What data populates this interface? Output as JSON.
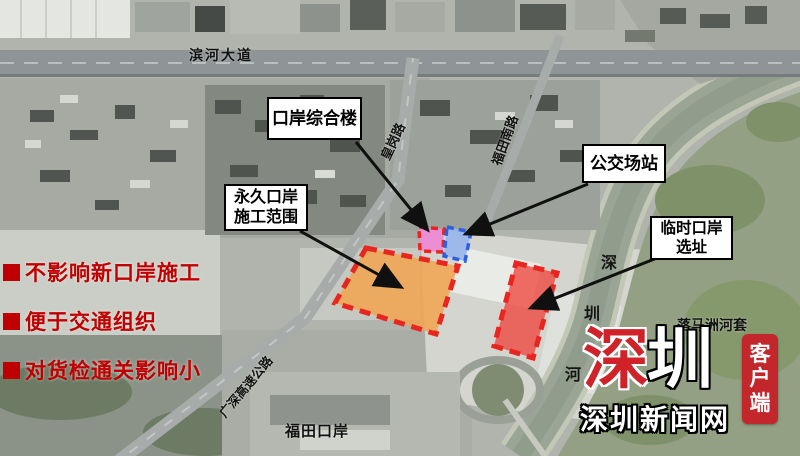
{
  "map_labels": {
    "binhe_avenue": "滨河大道",
    "huanggang_road": "皇岗路",
    "futian_south_road": "福田南路",
    "guangshen_expressway": "广深高速公路",
    "futian_port": "福田口岸",
    "lok_ma_chau_loop": "落马洲河套",
    "shenzhen_river_chars": [
      "深",
      "圳",
      "河"
    ]
  },
  "callouts": {
    "port_complex_building": {
      "label": "口岸综合楼"
    },
    "bus_station": {
      "label": "公交场站"
    },
    "permanent_port": {
      "line1": "永久口岸",
      "line2": "施工范围"
    },
    "temporary_port": {
      "line1": "临时口岸",
      "line2": "选址"
    }
  },
  "bullet_points": {
    "color": "#c00000",
    "items": [
      "不影响新口岸施工",
      "便于交通组织",
      "对货检通关影响小"
    ]
  },
  "zones": {
    "permanent_port_area": {
      "fill": "rgba(242,164,80,0.85)",
      "border": "#e8251f"
    },
    "temporary_port_area": {
      "fill": "rgba(238,70,62,0.78)",
      "border": "#e8251f"
    },
    "port_building_area": {
      "fill": "rgba(238,134,212,0.9)",
      "border": "#e8251f"
    },
    "bus_station_area": {
      "fill": "rgba(150,182,236,0.9)",
      "border": "#2e5fe0"
    }
  },
  "logo": {
    "brand_first_char": "深",
    "brand_second_char": "圳",
    "site_name": "深圳新闻网",
    "badge_chars": [
      "客",
      "户",
      "端"
    ],
    "brand_red": "#cf2229",
    "badge_bg": "#c3272b"
  }
}
